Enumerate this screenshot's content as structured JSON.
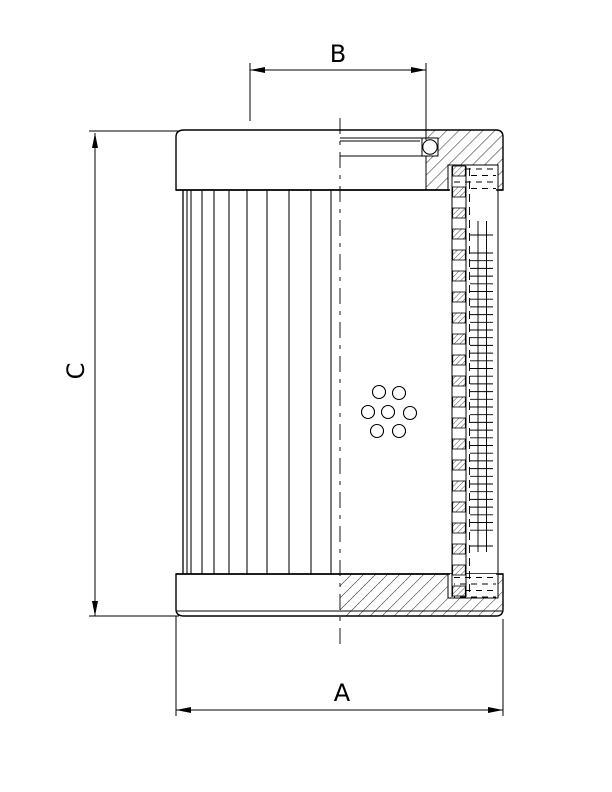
{
  "page": {
    "background": "#ffffff",
    "ink": "#000000",
    "description": "Technical section drawing of a cylindrical hydraulic filter element with pleated media, perforated core tube, wire mesh, O-ring seal and dimension callouts"
  },
  "dims": {
    "B": {
      "label": "B",
      "type": "h",
      "y": 70,
      "x1": 250,
      "x2": 426,
      "lx": 338,
      "ly": 62,
      "ext": [
        [
          250,
          63,
          250,
          121
        ],
        [
          426,
          63,
          426,
          140
        ]
      ]
    },
    "C": {
      "label": "C",
      "type": "v",
      "x": 95,
      "y1": 133,
      "y2": 616,
      "lx": 84,
      "ly": 371,
      "rotate": -90,
      "ext": [
        [
          89,
          131,
          179,
          131
        ],
        [
          89,
          616,
          179,
          616
        ]
      ]
    },
    "A": {
      "label": "A",
      "type": "h",
      "y": 710,
      "x1": 176,
      "x2": 503,
      "lx": 342,
      "ly": 701,
      "ext": [
        [
          176,
          616,
          176,
          716
        ],
        [
          503,
          619,
          503,
          716
        ]
      ]
    }
  },
  "drawing": {
    "pleats": {
      "xs": [
        183,
        187,
        191,
        202,
        214,
        229,
        247,
        267,
        289,
        311,
        331
      ],
      "y1": 190,
      "y2": 574
    },
    "holes": {
      "r": 6.5,
      "centers": [
        [
          379,
          392
        ],
        [
          399,
          393
        ],
        [
          368,
          412
        ],
        [
          388,
          412
        ],
        [
          410,
          413
        ],
        [
          377,
          431
        ],
        [
          399,
          431
        ]
      ]
    },
    "ladder": {
      "x": 452.7,
      "w": 12.6,
      "y0": 166,
      "step": 21,
      "h": 10,
      "count": 21
    },
    "mesh": {
      "x1": 470,
      "x2": 493,
      "first": 235,
      "last": 546,
      "start": 253,
      "end": 531,
      "step": 7.7
    },
    "glue": {
      "x1": 454,
      "x2": 496,
      "top_ys": [
        169,
        175.5,
        182,
        188.5
      ],
      "bottom_ys": [
        577.5,
        584,
        590.5,
        597
      ],
      "dash": "6 5"
    },
    "centerline": {
      "x": 340,
      "y1": 118,
      "y2": 650,
      "dash": "16 7 4 7"
    }
  }
}
